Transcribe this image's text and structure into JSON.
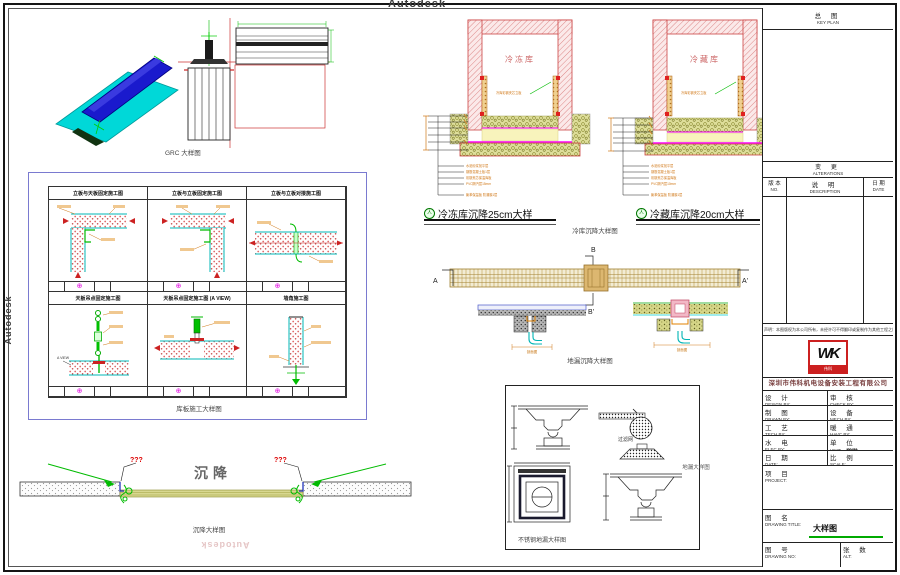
{
  "watermarks": {
    "top": "Autodesk",
    "left": "Autodesk",
    "right": "Autodesk",
    "bottom": "Autodesk"
  },
  "icons": {
    "section_mark": "⊕",
    "detail_mark": "人"
  },
  "grc": {
    "caption": "GRC 大样图"
  },
  "panel_grid": {
    "caption": "库板施工大样图",
    "cells": [
      {
        "title": "立板与天板固定施工图"
      },
      {
        "title": "立板与立板固定施工图"
      },
      {
        "title": "立板与立板对接施工图"
      },
      {
        "title": "天板吊点固定施工图",
        "view_label": "A VIEW"
      },
      {
        "title": "天板吊点固定施工图 (A VIEW)"
      },
      {
        "title": "墙角施工图"
      }
    ]
  },
  "cold_rooms": {
    "caption": "冷库沉降大样图",
    "freezer": {
      "room_label": "冷冻库",
      "title": "冷冻库沉降25cm大样",
      "wall_note": "冷库彩钢夹芯立板",
      "layers": [
        "水泥砂浆找平层",
        "钢筋混凝土板1层",
        "彩钢夹芯保温库板",
        "PVC隔汽层15mm",
        "聚苯保温板 防潮膜1层"
      ]
    },
    "chiller": {
      "room_label": "冷藏库",
      "title": "冷藏库沉降20cm大样",
      "wall_note": "冷库彩钢夹芯立板",
      "layers": [
        "水泥砂浆找平层",
        "钢筋混凝土板1层",
        "彩钢夹芯保温库板",
        "PVC隔汽层10mm",
        "聚苯保温板 防潮膜1层"
      ]
    }
  },
  "drain": {
    "caption": "地漏沉降大样图",
    "markers": {
      "a": "A",
      "a_prime": "A'",
      "b": "B",
      "b_prime": "B'"
    },
    "section_label": "剖面图"
  },
  "settlement": {
    "label": "沉降",
    "left_flag": "???",
    "right_flag": "???",
    "caption": "沉降大样图"
  },
  "ss_drain": {
    "caption": "不锈钢地漏大样图",
    "filter_label": "过滤网",
    "outside_caption": "地漏大样图"
  },
  "title_block": {
    "keyplan": {
      "cn": "总  图",
      "en": "KEY PLAN"
    },
    "alterations": {
      "cn": "变  更",
      "en": "ALTERATIONS"
    },
    "alt_cols": [
      {
        "cn": "版 本",
        "en": "NO."
      },
      {
        "cn": "说  明",
        "en": "DESCRIPTION"
      },
      {
        "cn": "日 期",
        "en": "DATE"
      }
    ],
    "note": "声明：本图版权为本公司所有，未经许可不得翻印或复制作为其他工程之用",
    "logo": {
      "text": "WK",
      "sub": "伟科"
    },
    "company": "深圳市伟科机电设备安装工程有限公司",
    "staff_rows": [
      {
        "l_cn": "设 计",
        "l_en": "DESIGN BY:",
        "r_cn": "审 核",
        "r_en": "CHECK BY:"
      },
      {
        "l_cn": "制 图",
        "l_en": "DRAWN BY:",
        "r_cn": "设 备",
        "r_en": "MECH BY:"
      },
      {
        "l_cn": "工 艺",
        "l_en": "TECH BY:",
        "r_cn": "暖 通",
        "r_en": "HAVC BY:"
      },
      {
        "l_cn": "水 电",
        "l_en": "ELEC BY:",
        "r_cn": "单 位",
        "r_en": "UNIT:",
        "r_val": "mm"
      },
      {
        "l_cn": "日 期",
        "l_en": "DATE:",
        "r_cn": "比 例",
        "r_en": "SCALE:"
      }
    ],
    "project": {
      "cn": "项  目",
      "en": "PROJECT:"
    },
    "drawing_title": {
      "cn": "图  名",
      "en": "DRAWING TITLE:",
      "value": "大样图"
    },
    "drawing_no": {
      "cn": "图  号",
      "en": "DRAWING NO:"
    },
    "sheets": {
      "cn": "张 数",
      "en": "ALT:"
    }
  },
  "colors": {
    "wall_hatch": "#e8a0a0",
    "wall_line": "#cc4444",
    "gravel": "#dede9a",
    "slab": "#f8f3bc",
    "magenta": "#ff00ff",
    "green": "#00b400",
    "cyan": "#00c8c8",
    "orange": "#d07818",
    "panel_border_blue": "#7a7ad0",
    "logo_red": "#cc2020",
    "underline_green": "#00aa00"
  }
}
